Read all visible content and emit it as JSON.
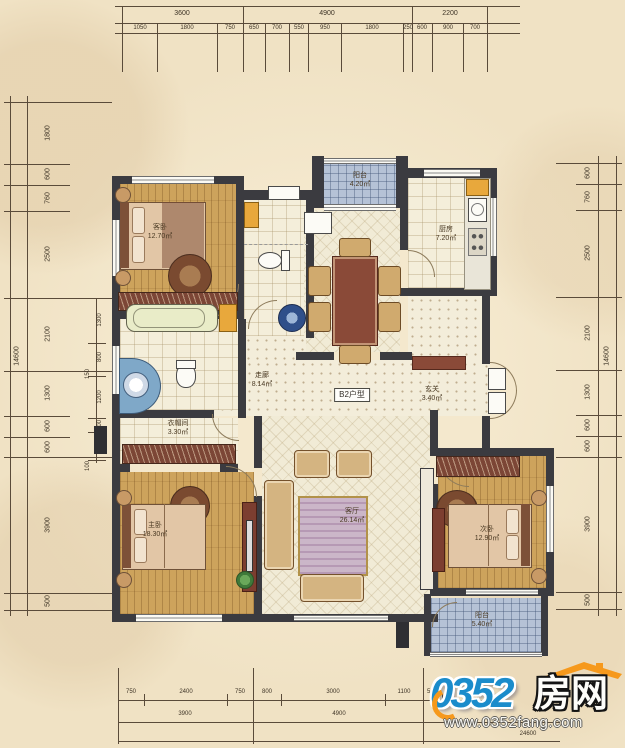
{
  "plan": {
    "type_label": "B2户型",
    "rooms": [
      {
        "id": "balcony-top",
        "name": "阳台",
        "area": "4.20㎡"
      },
      {
        "id": "kitchen",
        "name": "厨房",
        "area": "7.20㎡"
      },
      {
        "id": "bedroom-guest",
        "name": "客卧",
        "area": "12.70㎡"
      },
      {
        "id": "corridor",
        "name": "走廊",
        "area": "8.14㎡"
      },
      {
        "id": "foyer",
        "name": "玄关",
        "area": "3.40㎡"
      },
      {
        "id": "closet",
        "name": "衣帽间",
        "area": "3.30㎡"
      },
      {
        "id": "bedroom-master",
        "name": "主卧",
        "area": "18.30㎡"
      },
      {
        "id": "living",
        "name": "客厅",
        "area": "26.14㎡"
      },
      {
        "id": "bedroom-second",
        "name": "次卧",
        "area": "12.90㎡"
      },
      {
        "id": "balcony-bottom",
        "name": "阳台",
        "area": "5.40㎡"
      }
    ]
  },
  "dims": {
    "top": {
      "row1": [
        "3600",
        "4900",
        "2200"
      ],
      "row2": [
        "1050",
        "1800",
        "750",
        "650",
        "700",
        "550",
        "950",
        "1800",
        "250",
        "600",
        "900",
        "700"
      ]
    },
    "bottom": {
      "row1": [
        "750",
        "2400",
        "750",
        "800",
        "3000",
        "1100",
        "550"
      ],
      "row2": [
        "3900",
        "4900"
      ],
      "total": "24600"
    },
    "left": {
      "total": "14600",
      "chain": [
        "1800",
        "600",
        "760",
        "2500",
        "2100",
        "1300",
        "600",
        "600",
        "3900",
        "500"
      ],
      "inner": [
        "1300",
        "800",
        "150",
        "1200",
        "400",
        "600",
        "100"
      ]
    },
    "right": {
      "total": "14600",
      "chain": [
        "600",
        "760",
        "2500",
        "2100",
        "1300",
        "600",
        "600",
        "3900",
        "500"
      ]
    }
  },
  "logo": {
    "number": "0352",
    "name": "房网",
    "url": "www.0352fang.com",
    "blue": "#1b8ccb",
    "orange": "#f6991c"
  },
  "colors": {
    "background": "#f0e2c4",
    "wall": "#3b3b40",
    "wood_floor": "#cda35c",
    "tile_floor": "#f4eeda",
    "balcony_tile": "#b5c2d6",
    "dimension_line": "#5a4b3a"
  }
}
